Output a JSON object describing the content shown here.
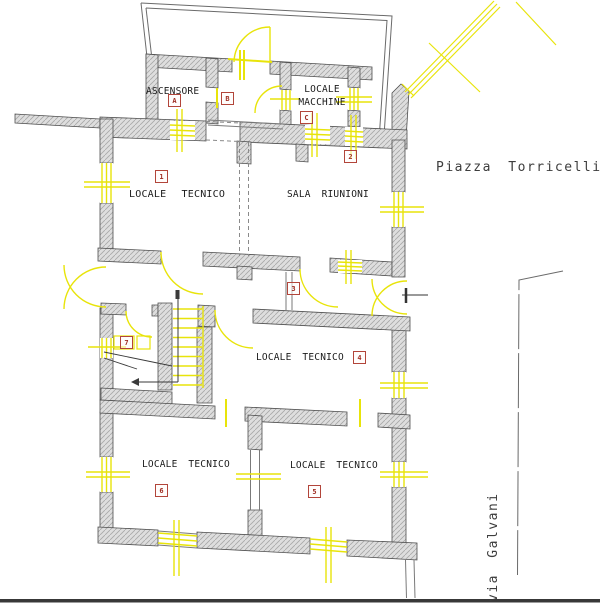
{
  "drawing": {
    "streets": {
      "piazza": "Piazza Torricelli",
      "via": "via Galvani"
    },
    "labels": {
      "ascensore": "ASCENSORE",
      "macchine_1": "LOCALE",
      "macchine_2": "MACCHINE",
      "tecnico_1": "LOCALE TECNICO",
      "sala": "SALA RIUNIONI",
      "tecnico_4": "LOCALE TECNICO",
      "tecnico_6": "LOCALE TECNICO",
      "tecnico_5": "LOCALE TECNICO"
    },
    "markers": {
      "a": "A",
      "b": "B",
      "c": "C",
      "n1": "1",
      "n2": "2",
      "n3": "3",
      "n4": "4",
      "n5": "5",
      "n6": "6",
      "n7": "7"
    },
    "colors": {
      "wall_fill": "#dedede",
      "wall_hatch": "#a8a8a8",
      "wall_edge": "#4f4f4f",
      "accent_yellow": "#e8e40a",
      "marker_red": "#a03126",
      "label_text": "#1b1b1b",
      "street_text": "#3d3d3d",
      "boundary_gray": "#6a6a6a",
      "ground_line": "#383838"
    }
  }
}
